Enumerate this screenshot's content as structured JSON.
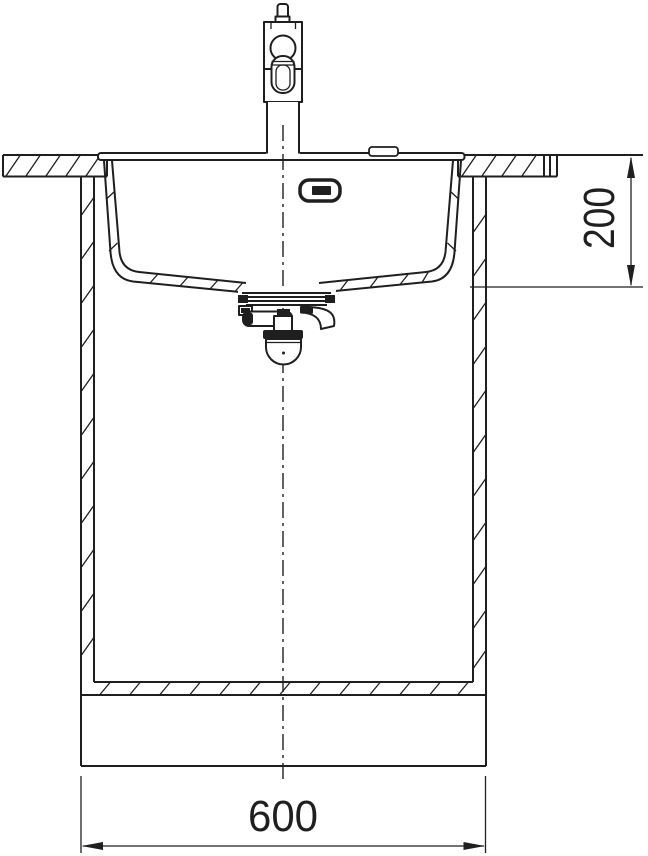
{
  "drawing": {
    "kind": "sink-installation-front-section",
    "line_color": "#1f1f1f",
    "background_color": "#ffffff",
    "labels": {
      "depth_mm": "200",
      "width_mm": "600"
    },
    "components": [
      "faucet",
      "tap-hole-cover",
      "countertop",
      "sink-basin",
      "overflow-outlet",
      "drain-trap",
      "base-cabinet",
      "centerline"
    ]
  }
}
